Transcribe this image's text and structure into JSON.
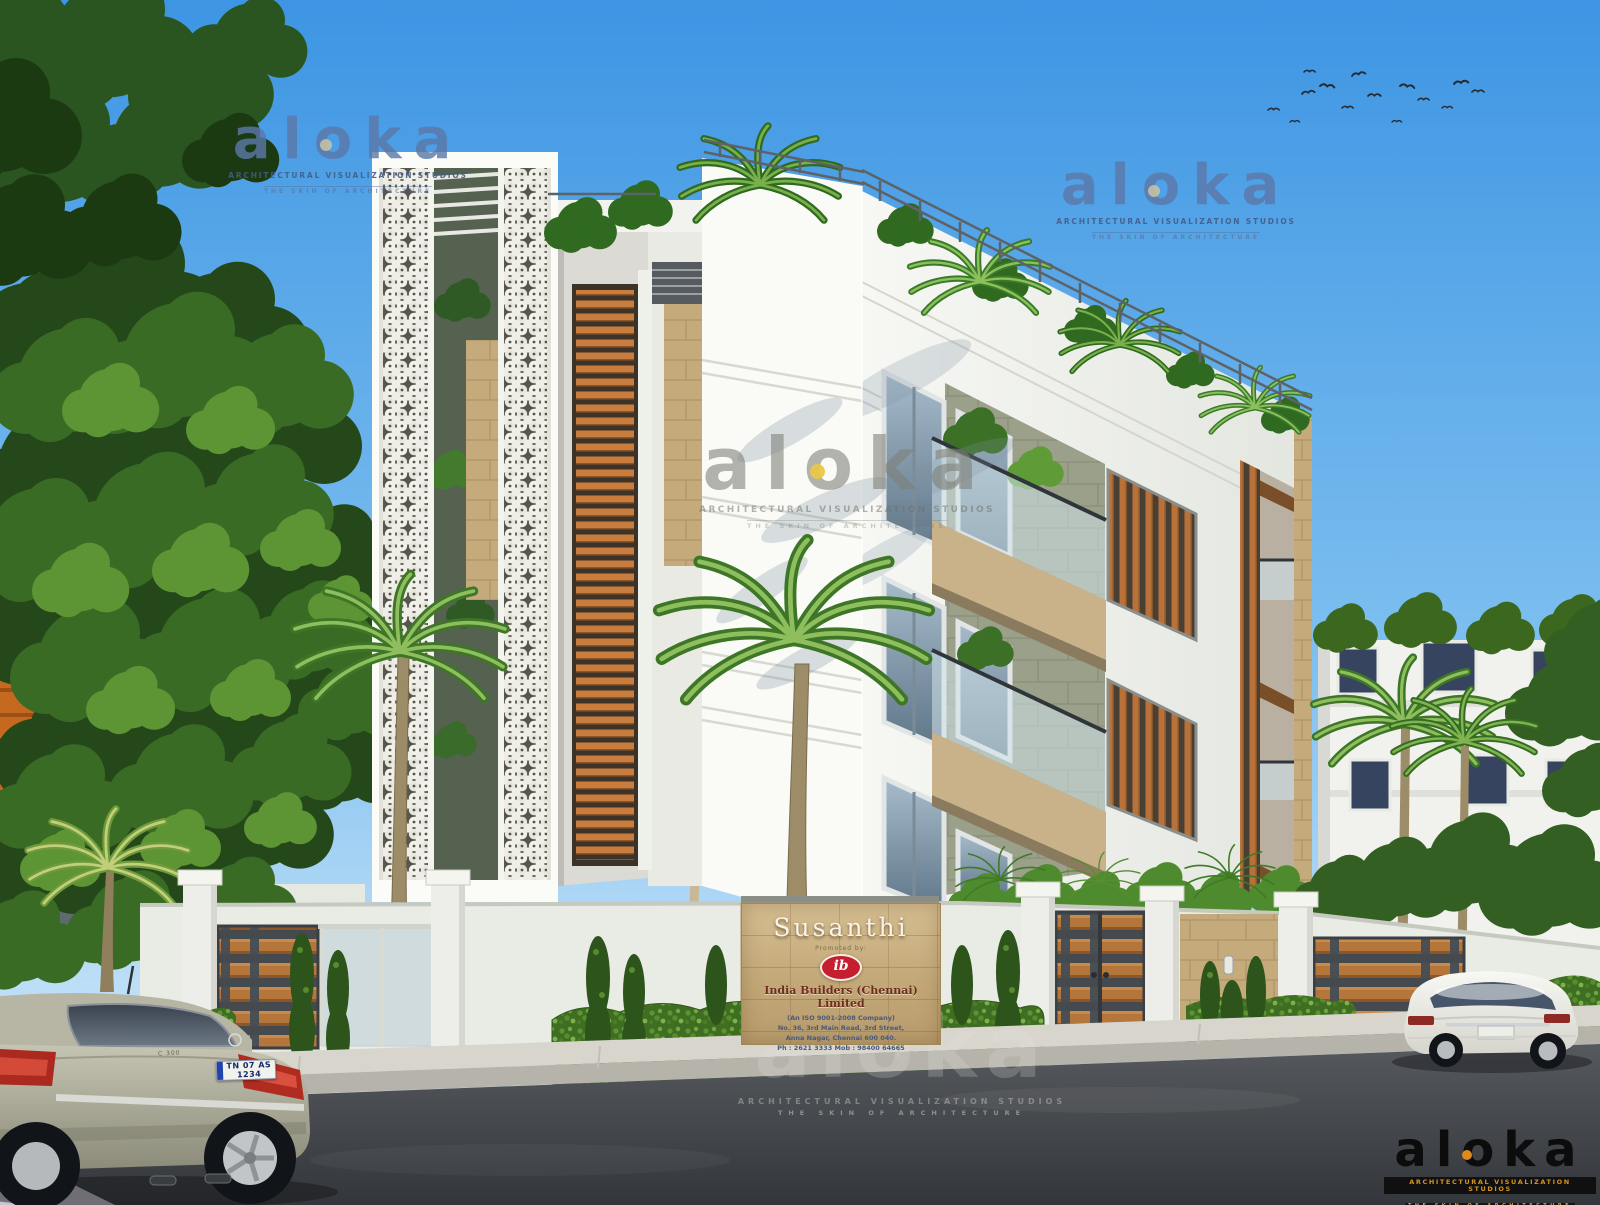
{
  "watermarks": {
    "brand": "aloka",
    "studio_line": "ARCHITECTURAL VISUALIZATION STUDIOS",
    "tagline": "THE SKIN OF ARCHITECTURE"
  },
  "signboard": {
    "project_name": "Susanthi",
    "promoted_by": "Promoted by:",
    "builder_logo": "ib",
    "company": "India Builders (Chennai) Limited",
    "iso_line": "(An ISO 9001-2008 Company)",
    "address_line1": "No. 36, 3rd Main Road, 3rd Street,",
    "address_line2": "Anna Nagar, Chennai 600 040.",
    "phone_line": "Ph : 2621 3333  Mob : 98400 64665"
  },
  "vehicles": {
    "left_car_plate": "TN 07 AS 1234",
    "left_car_badge": "C 300"
  },
  "colors": {
    "sky_top": "#3D95E3",
    "sky_horizon": "#DFF0FC",
    "building_white": "#F6F7F3",
    "stone_tan": "#C5AB7C",
    "stone_olive": "#9AA089",
    "wood_louver": "#C87C3E",
    "hedge_green": "#3F6D22",
    "road_asphalt": "#3C3F43",
    "builder_red": "#C41E2F",
    "logo_blue_tint": "#5C78A8",
    "logo_black": "#0C0C0C",
    "logo_orange": "#D9921F",
    "logo_dot_yellow": "#E8C84A"
  }
}
